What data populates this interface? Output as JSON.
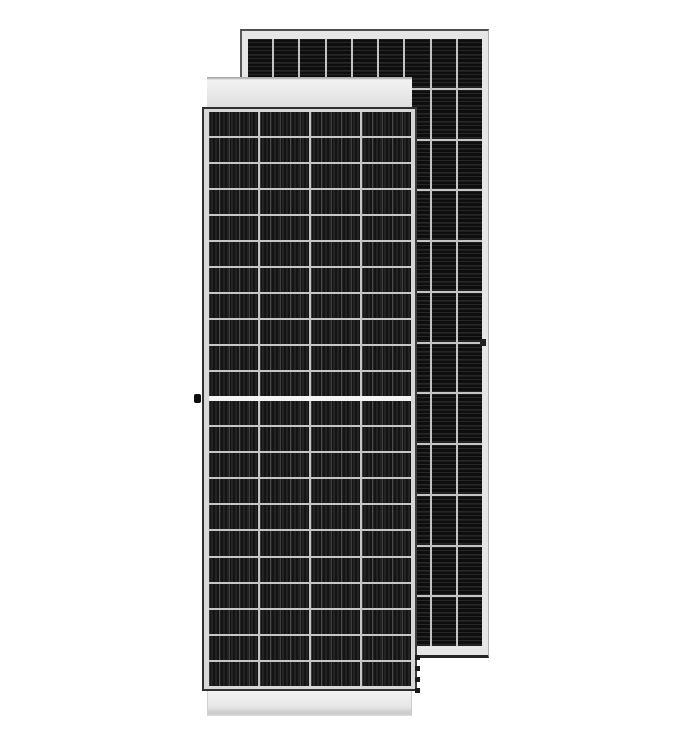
{
  "scene": {
    "description": "Product render of a monocrystalline half-cut solar panel shown from the front, overlapping a second panel shown from the back",
    "background_color": "#ffffff"
  },
  "front_panel": {
    "label": "solar-panel-front-view",
    "columns": 4,
    "rows_upper": 11,
    "rows_lower": 11,
    "cell_color": "#191919",
    "cell_stripe_color": "#232323",
    "busbar_color": "rgba(255,255,255,0.18)",
    "grid_line_color": "#c6c6c6",
    "frame_color": "#e9e9e9",
    "glass_edge_color": "#303030",
    "center_gap_color": "#f3f3f3"
  },
  "back_panel": {
    "label": "solar-panel-back-view",
    "columns": 9,
    "rows": 12,
    "cell_color": "#121212",
    "cell_stripe_color": "#272727",
    "grid_line_color": "#c4c4c4",
    "frame_color": "#e6e6e6"
  }
}
